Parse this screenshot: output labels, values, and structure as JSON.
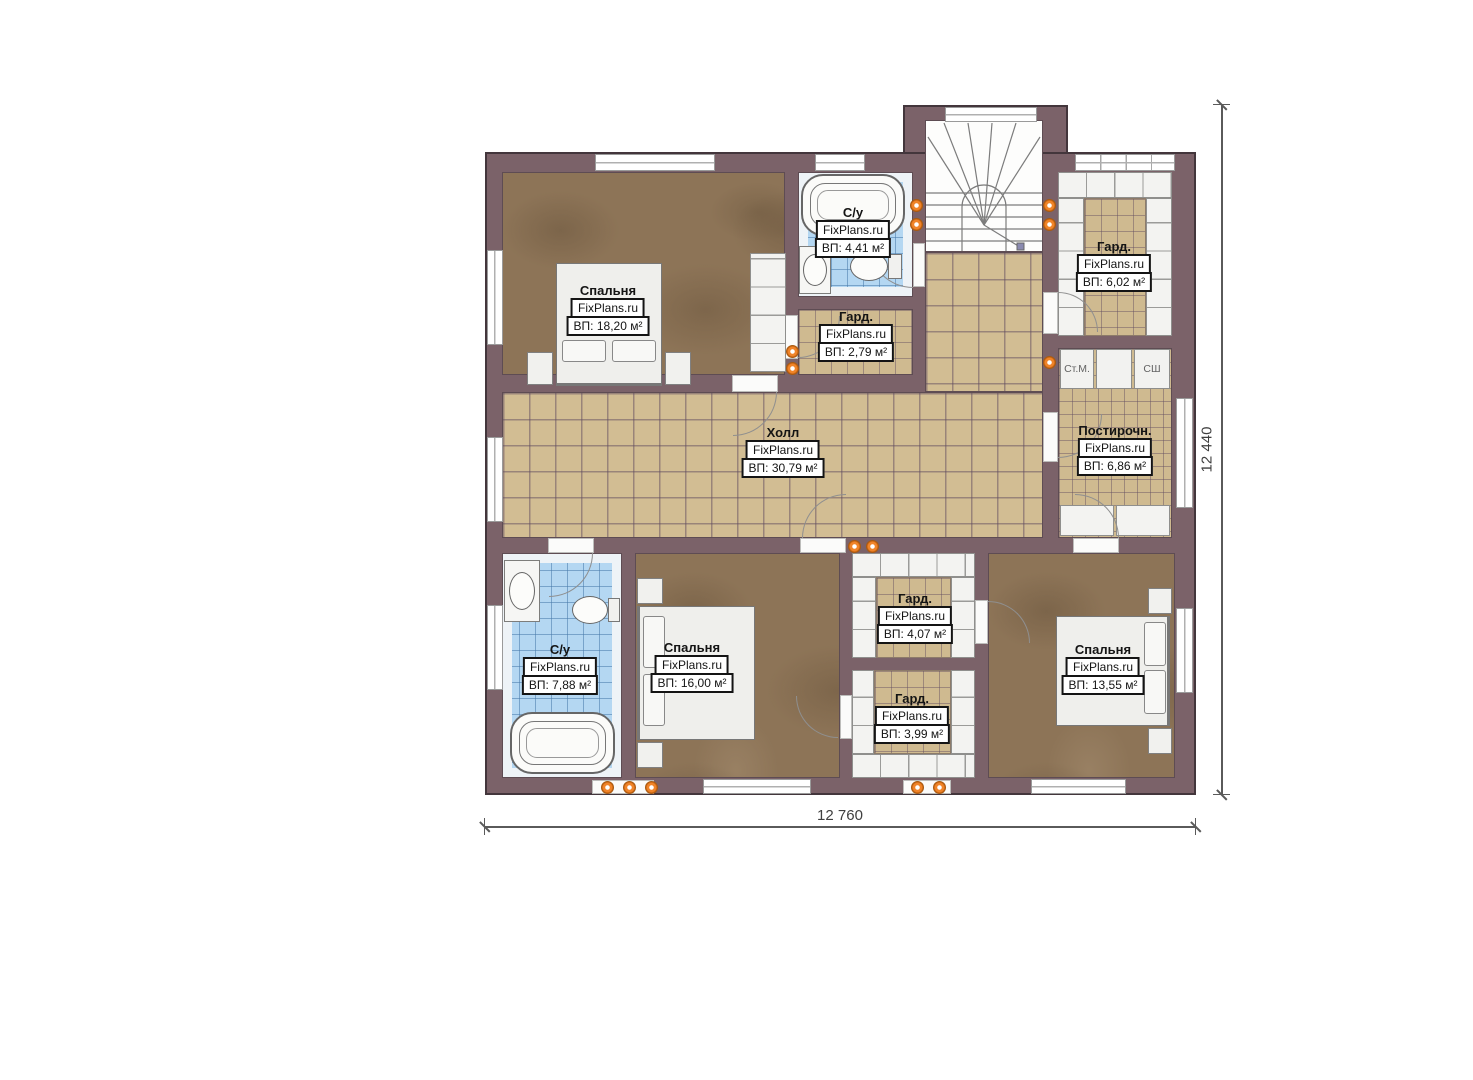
{
  "plan": {
    "type": "floor-plan-second-floor",
    "brand": "FixPlans.ru"
  },
  "rooms": [
    {
      "id": "bedroom-top-left",
      "name": "Спальня",
      "brand": "FixPlans.ru",
      "area": "ВП: 18,20 м²"
    },
    {
      "id": "bathroom-top",
      "name": "С/у",
      "brand": "FixPlans.ru",
      "area": "ВП: 4,41 м²"
    },
    {
      "id": "wardrobe-top-center",
      "name": "Гард.",
      "brand": "FixPlans.ru",
      "area": "ВП: 2,79 м²"
    },
    {
      "id": "wardrobe-top-right",
      "name": "Гард.",
      "brand": "FixPlans.ru",
      "area": "ВП: 6,02 м²"
    },
    {
      "id": "hall",
      "name": "Холл",
      "brand": "FixPlans.ru",
      "area": "ВП: 30,79 м²"
    },
    {
      "id": "laundry",
      "name": "Постирочн.",
      "brand": "FixPlans.ru",
      "area": "ВП: 6,86 м²"
    },
    {
      "id": "bathroom-bottom-left",
      "name": "С/у",
      "brand": "FixPlans.ru",
      "area": "ВП: 7,88 м²"
    },
    {
      "id": "bedroom-bottom-middle",
      "name": "Спальня",
      "brand": "FixPlans.ru",
      "area": "ВП: 16,00 м²"
    },
    {
      "id": "wardrobe-middle-upper",
      "name": "Гард.",
      "brand": "FixPlans.ru",
      "area": "ВП: 4,07 м²"
    },
    {
      "id": "wardrobe-middle-lower",
      "name": "Гард.",
      "brand": "FixPlans.ru",
      "area": "ВП: 3,99 м²"
    },
    {
      "id": "bedroom-bottom-right",
      "name": "Спальня",
      "brand": "FixPlans.ru",
      "area": "ВП: 13,55 м²"
    }
  ],
  "appliances": {
    "washer": "Ст.М.",
    "dryer": "СШ"
  },
  "dimensions": {
    "width_label": "12 760",
    "height_label": "12 440"
  },
  "colors": {
    "wall": "#7b6269",
    "wall_outline": "#43363c",
    "wood_floor": "#8d7457",
    "tile_floor": "#d2bd93",
    "bath_tile": "#b4d7f2",
    "socket_marker": "#f08429"
  }
}
